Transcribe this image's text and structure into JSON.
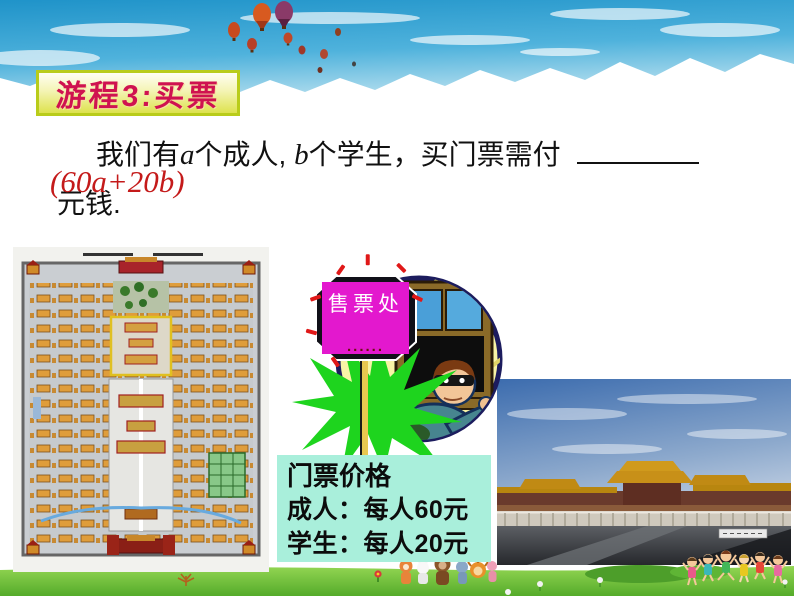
{
  "slide": {
    "title": "游程3:买票",
    "question": {
      "part1": "我们有",
      "var1": "a",
      "part2": "个成人,",
      "var2": "b",
      "part3": "个学生，买门票需付",
      "part4": "元钱.",
      "answer": "(60a+20b)"
    },
    "ticket_sign": {
      "label": "售票处",
      "dots": "......"
    },
    "price_board": {
      "title": "门票价格",
      "adult_line": "成人：每人60元",
      "student_line": "学生：每人20元"
    },
    "prices": {
      "adult_yuan": 60,
      "student_yuan": 20
    },
    "colors": {
      "title_text": "#cf1250",
      "banner_border": "#b9cc1a",
      "sign_magenta": "#e318ce",
      "price_box_bg": "#a9efdb",
      "burst_green": "#1ed41e",
      "answer_red": "#c41a1a",
      "sky_blue": "#2e9fd0",
      "grass_green": "#6fc23c"
    },
    "illustrations": {
      "header": "blue-sky-with-clouds-and-hot-air-balloons",
      "map": "forbidden-city-plan-map",
      "booth": "masked-ticket-seller-at-window",
      "photo": "forbidden-city-photograph",
      "footer": "grass-with-cartoon-children-and-animals"
    }
  }
}
